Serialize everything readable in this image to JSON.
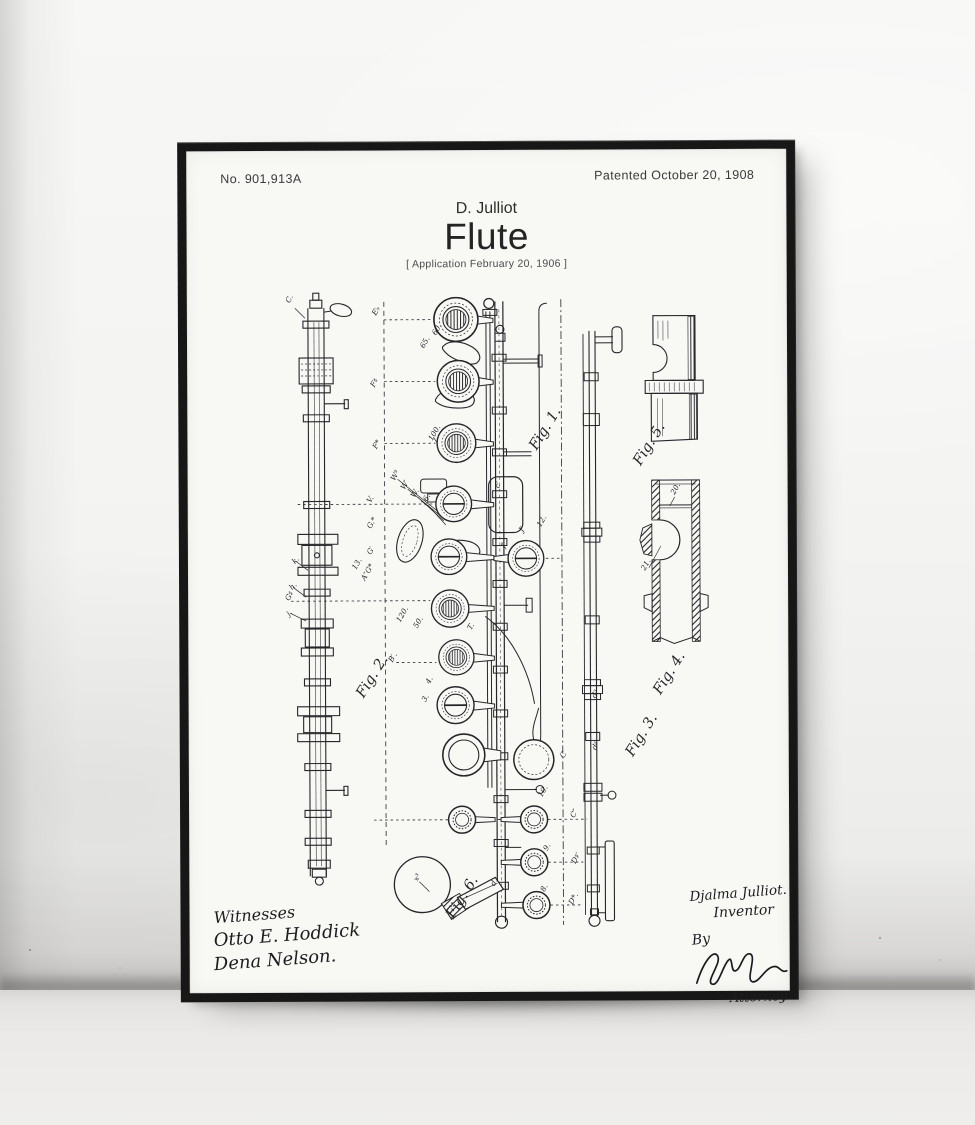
{
  "poster": {
    "patent_number": "No. 901,913A",
    "patent_date": "Patented October 20, 1908",
    "inventor": "D. Julliot",
    "title": "Flute",
    "application_note": "[ Application February 20, 1906 ]"
  },
  "signatures": {
    "witnesses_label": "Witnesses",
    "witness_1": "Otto E. Hoddick",
    "witness_2": "Dena Nelson.",
    "inventor_signature": "Djalma Julliot.",
    "inventor_label": "Inventor",
    "by_label": "By",
    "attorney_label": "Attorney"
  },
  "drawing": {
    "figure_labels": [
      "Fig. 1.",
      "Fig. 2.",
      "Fig. 3.",
      "Fig. 4.",
      "Fig. 5.",
      "Fig. 6."
    ],
    "part_labels": [
      "C.",
      "E♭",
      "60.",
      "65.",
      "F♯",
      "100.",
      "F*",
      "W³",
      "W′",
      "W.",
      "16.",
      "V.",
      "G.*",
      "G′",
      "A″G*",
      "13.",
      "G♯",
      "120.",
      "50.",
      "B′.",
      "4.",
      "3.",
      "T.",
      "J′",
      "12.",
      "10.",
      "9.",
      "8.",
      "d.",
      "C′",
      "C″",
      "D♯′",
      "D*.",
      "d²",
      "d³",
      "20.",
      "21.",
      "x³",
      "c′",
      "f′",
      "k.",
      "h.",
      "j."
    ]
  },
  "colors": {
    "frame": "#171717",
    "paper": "#f8f8f5",
    "wall": "#f3f3f1",
    "floor": "#ebeae8",
    "ink": "#26262a"
  }
}
